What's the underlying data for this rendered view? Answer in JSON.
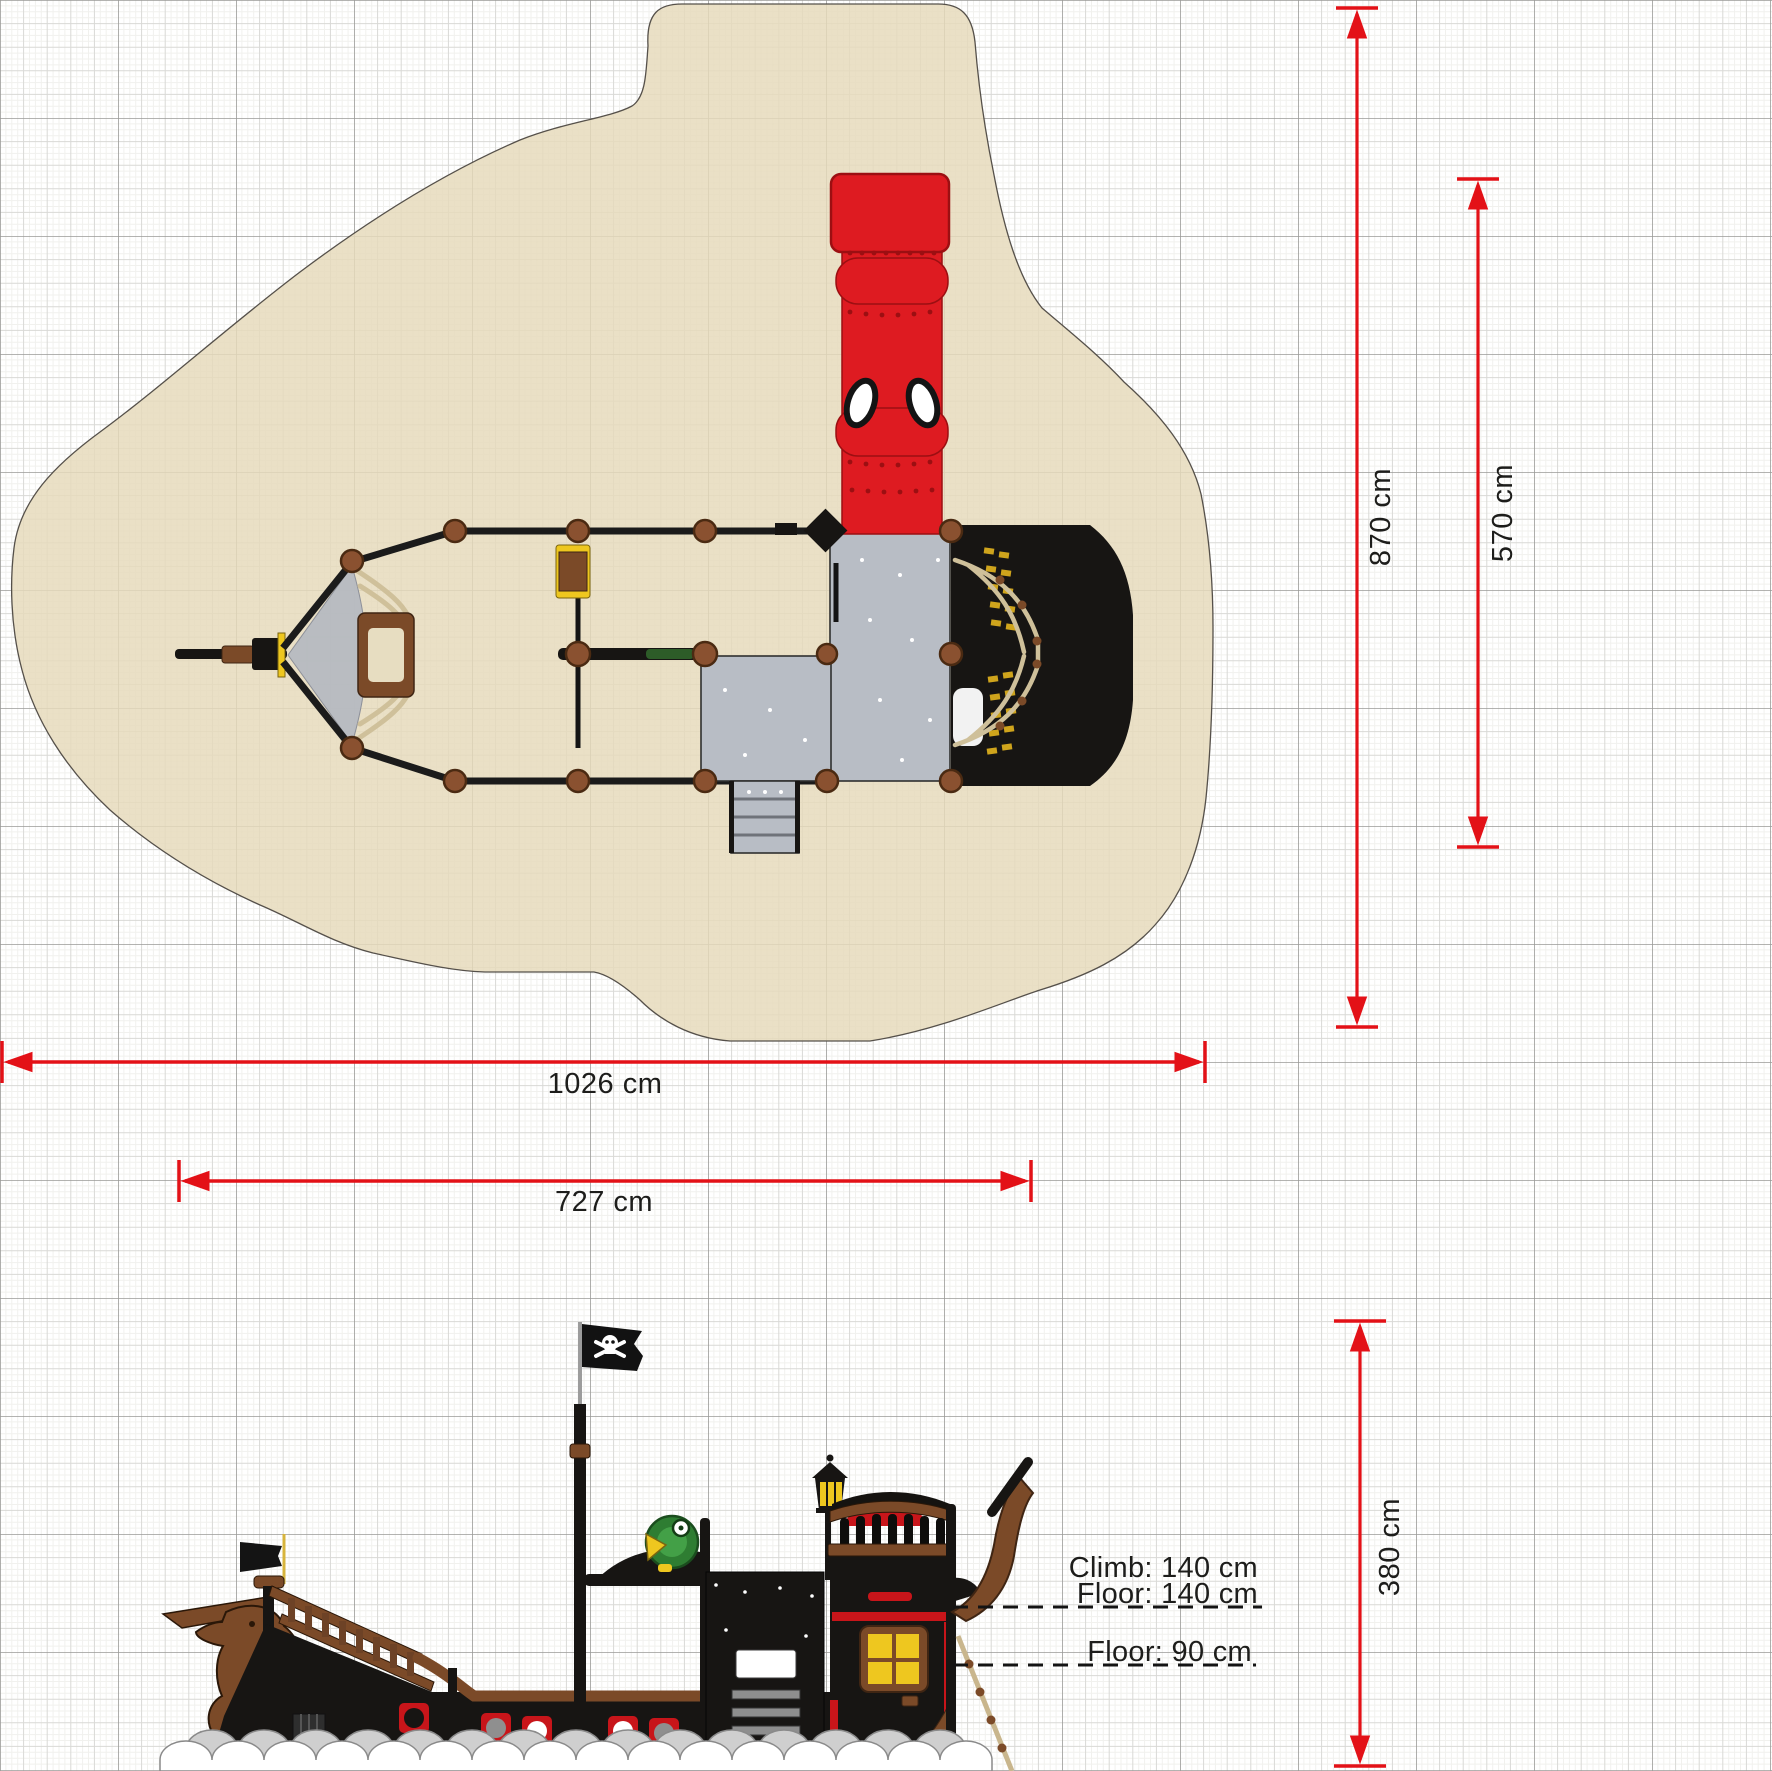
{
  "drawing": {
    "kind": "playground-equipment-technical-drawing",
    "subject": "pirate ship play structure",
    "views": {
      "top": "plan view with safety surfacing zone",
      "bottom": "side elevation view"
    }
  },
  "dimensions": {
    "zone_length": {
      "label": "1026 cm",
      "value_cm": 1026,
      "orientation": "horizontal",
      "applies_to": "safety zone overall length"
    },
    "ship_length": {
      "label": "727 cm",
      "value_cm": 727,
      "orientation": "horizontal",
      "applies_to": "equipment length"
    },
    "zone_width": {
      "label": "870 cm",
      "value_cm": 870,
      "orientation": "vertical",
      "applies_to": "safety zone overall width"
    },
    "inner_width": {
      "label": "570 cm",
      "value_cm": 570,
      "orientation": "vertical",
      "applies_to": "zone width at tower side"
    },
    "total_height": {
      "label": "380 cm",
      "value_cm": 380,
      "orientation": "vertical",
      "applies_to": "equipment height"
    }
  },
  "annotations": {
    "climb": {
      "label": "Climb: 140 cm",
      "value_cm": 140
    },
    "floor_upper": {
      "label": "Floor: 140 cm",
      "value_cm": 140
    },
    "floor_lower": {
      "label": "Floor: 90 cm",
      "value_cm": 90
    }
  },
  "colors": {
    "dimension_red": "#e31117",
    "safety_zone_beige": "#eae0c6",
    "deck_gray": "#b8bdc5",
    "wood_brown": "#7b4a28",
    "accent_yellow": "#eec71f",
    "structure_black": "#171513",
    "slide_red": "#de1b21",
    "parrot_green": "#2e7d32",
    "grid_major": "#9a9a97",
    "grid_minor": "#d9d9d6"
  }
}
